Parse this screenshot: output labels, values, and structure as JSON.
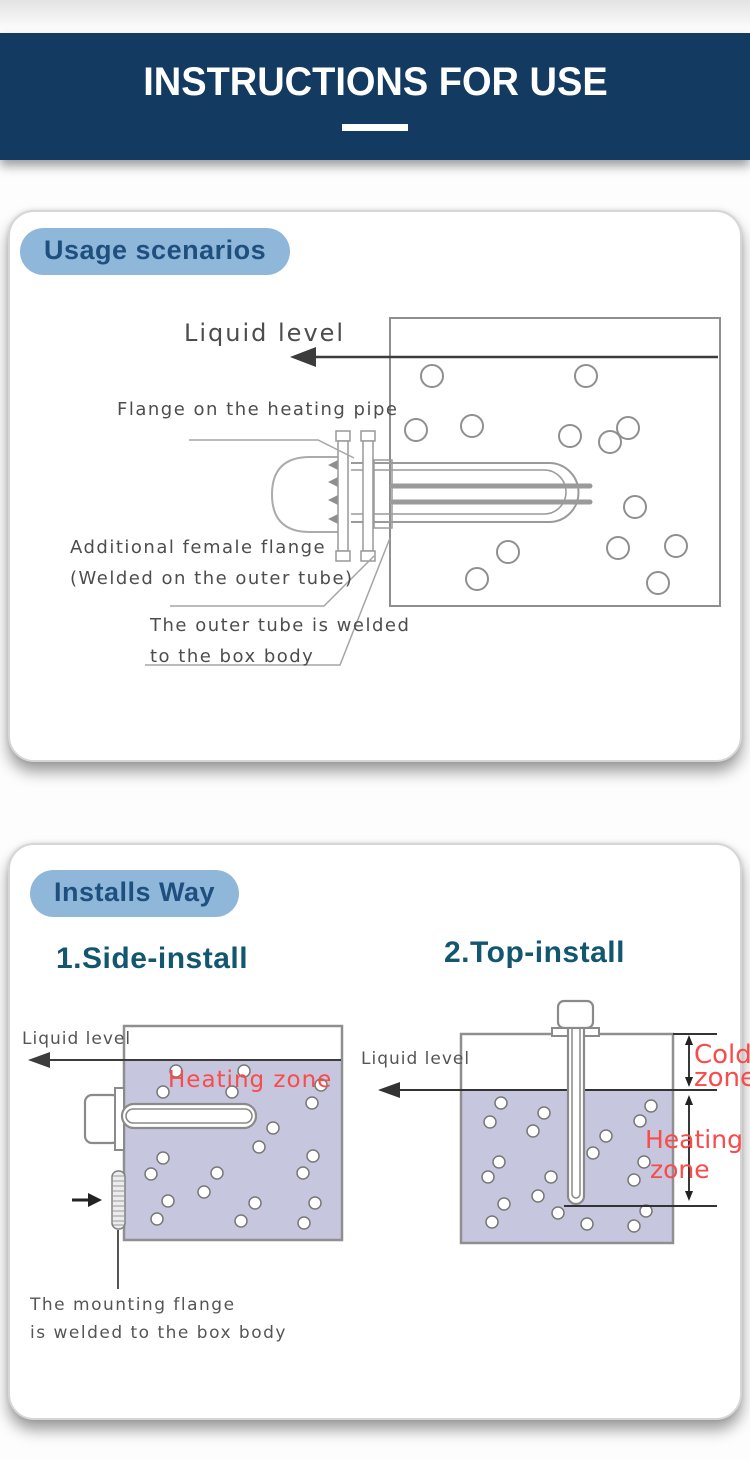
{
  "header": {
    "title": "INSTRUCTIONS FOR USE"
  },
  "colors": {
    "navy_band": "#133a60",
    "badge_bg": "#8fb7da",
    "badge_text": "#1f4f7e",
    "section_heading": "#12566f",
    "zone_red": "#fa4a4a",
    "water_fill": "#c6c7de"
  },
  "usage_section": {
    "badge_label": "Usage scenarios",
    "diagram": {
      "liquid_level_label": "Liquid level",
      "flange_label": "Flange on the heating pipe",
      "female_flange_label_line1": "Additional female flange",
      "female_flange_label_line2": "(Welded on the outer tube)",
      "outer_tube_label_line1": "The outer tube is welded",
      "outer_tube_label_line2": "to the box body"
    }
  },
  "installs_section": {
    "badge_label": "Installs Way",
    "side_install": {
      "heading": "1.Side-install",
      "liquid_level_label": "Liquid level",
      "heating_zone_label": "Heating zone",
      "caption_line1": "The mounting flange",
      "caption_line2": "is welded to the box body"
    },
    "top_install": {
      "heading": "2.Top-install",
      "liquid_level_label": "Liquid level",
      "cold_zone_label_line1": "Cold",
      "cold_zone_label_line2": "zone",
      "heating_zone_label_line1": "Heating",
      "heating_zone_label_line2": "zone"
    }
  }
}
